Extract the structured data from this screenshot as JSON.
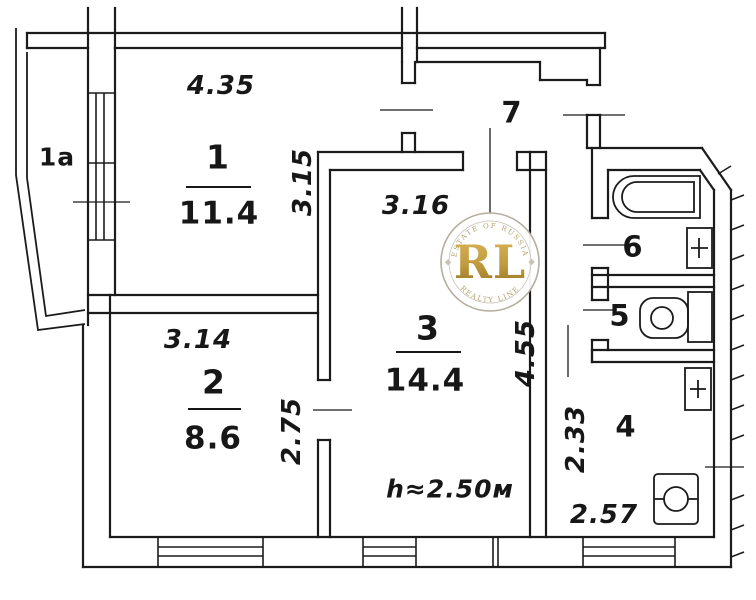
{
  "plan": {
    "background": "#ffffff",
    "ink": "#1b1b1b",
    "rooms": [
      {
        "number": "1a"
      },
      {
        "number": "1",
        "area": "11.4"
      },
      {
        "number": "2",
        "area": "8.6"
      },
      {
        "number": "3",
        "area": "14.4"
      },
      {
        "number": "4"
      },
      {
        "number": "5"
      },
      {
        "number": "6"
      },
      {
        "number": "7"
      }
    ],
    "dimensions": {
      "room1_width": "4.35",
      "room1_depth": "3.15",
      "room2_width": "3.14",
      "room2_depth": "2.75",
      "room3_width": "3.16",
      "room3_depth": "4.55",
      "kitchen_depth": "2.33",
      "kitchen_width": "2.57",
      "ceiling_height": "h≈2.50м"
    },
    "watermark": {
      "initials": "RL",
      "arc_top": "ESTATE OF RUSSIA",
      "arc_bottom": "REALTY LINE",
      "gold_color": "#bf9b3f",
      "ring_color": "#b5aea0"
    }
  }
}
